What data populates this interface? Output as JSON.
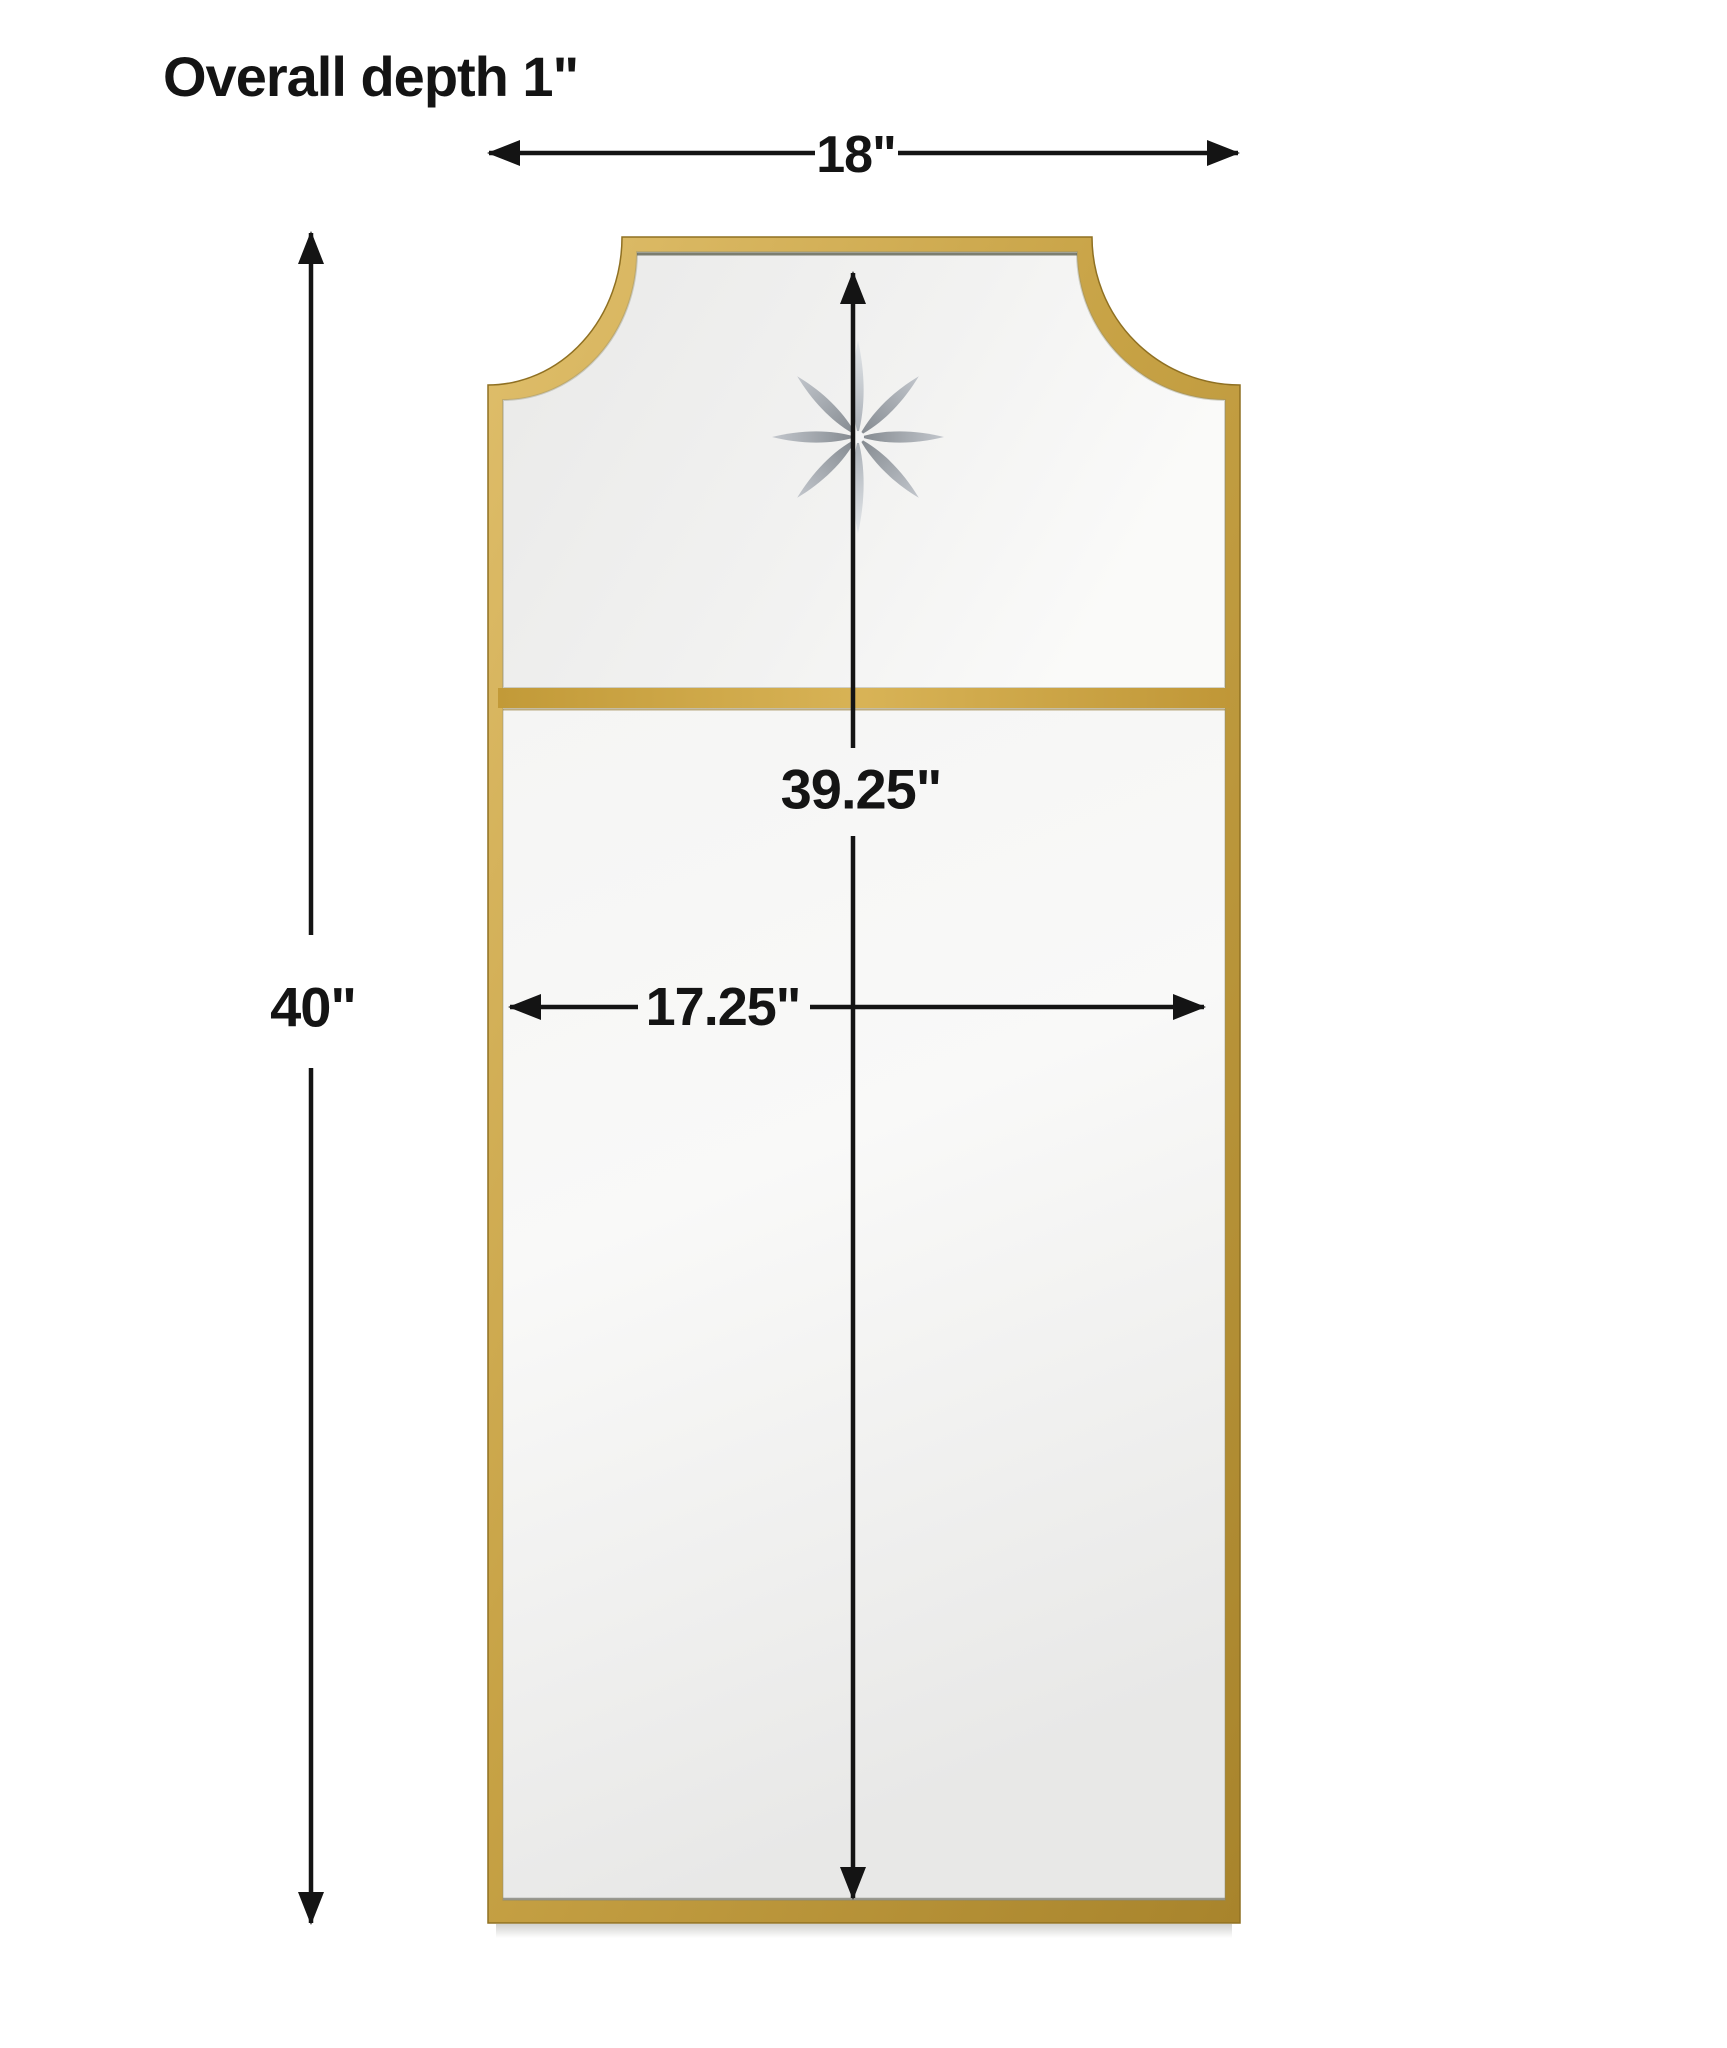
{
  "title": "Overall depth 1\"",
  "dimensions": {
    "overall_width": "18\"",
    "overall_height": "40\"",
    "inner_height": "39.25\"",
    "inner_width": "17.25\""
  },
  "figure": {
    "subject": "Arched-top rectangular wall mirror with brass frame, scooped top corners, horizontal divider rail and etched star",
    "etching_icon": "eight-petal-star-etching"
  },
  "colors": {
    "background": "#ffffff",
    "frame_gold": "#c49e40",
    "frame_gold_light": "#e3c473",
    "frame_gold_dark": "#a37f28",
    "glass_light": "#f8f8f7",
    "glass_dark": "#e8e8e7",
    "dimension_ink": "#141414"
  }
}
